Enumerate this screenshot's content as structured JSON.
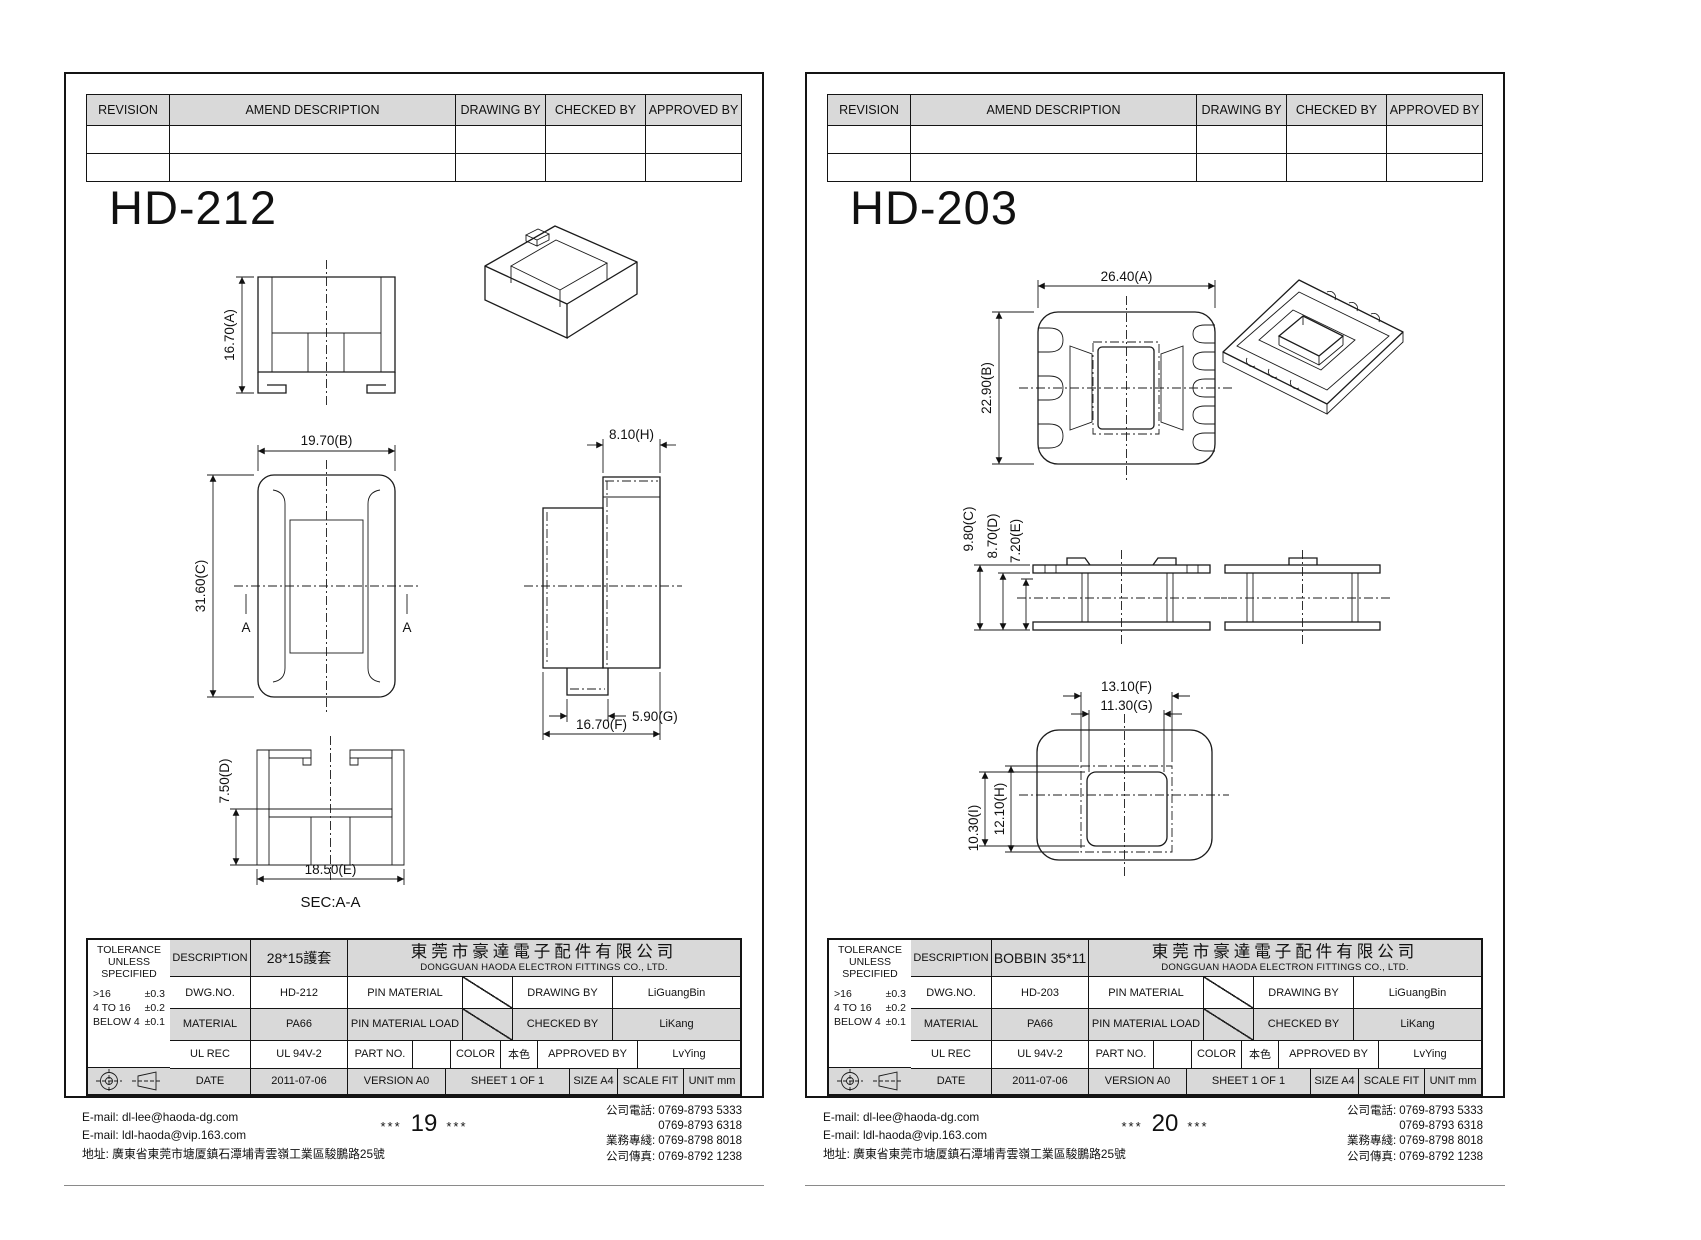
{
  "sheets": [
    {
      "title": "HD-212",
      "revision": {
        "headers": [
          "REVISION",
          "AMEND DESCRIPTION",
          "DRAWING BY",
          "CHECKED BY",
          "APPROVED BY"
        ]
      },
      "dims": {
        "a": "16.70(A)",
        "b": "19.70(B)",
        "c": "31.60(C)",
        "d": "7.50(D)",
        "e": "18.50(E)",
        "f": "16.70(F)",
        "g": "5.90(G)",
        "h": "8.10(H)"
      },
      "section": {
        "marker": "A",
        "label": "SEC:A-A"
      },
      "tb": {
        "tolerance_title": "TOLERANCE UNLESS SPECIFIED",
        "tol": [
          {
            "range": ">16",
            "val": "±0.3"
          },
          {
            "range": "4 TO 16",
            "val": "±0.2"
          },
          {
            "range": "BELOW 4",
            "val": "±0.1"
          }
        ],
        "description_label": "DESCRIPTION",
        "description": "28*15護套",
        "company_cn": "東莞市豪達電子配件有限公司",
        "company_en": "DONGGUAN HAODA ELECTRON FITTINGS CO., LTD.",
        "dwg_label": "DWG.NO.",
        "dwg": "HD-212",
        "pin_material_label": "PIN MATERIAL",
        "drawing_by_label": "DRAWING BY",
        "drawing_by": "LiGuangBin",
        "material_label": "MATERIAL",
        "material": "PA66",
        "pin_load_label": "PIN MATERIAL LOAD",
        "checked_by_label": "CHECKED BY",
        "checked_by": "LiKang",
        "ul_label": "UL REC",
        "ul": "UL 94V-2",
        "part_label": "PART NO.",
        "part": "",
        "color_label": "COLOR",
        "color": "本色",
        "approved_by_label": "APPROVED BY",
        "approved_by": "LvYing",
        "date_label": "DATE",
        "date": "2011-07-06",
        "version": "VERSION A0",
        "sheet": "SHEET 1 OF 1",
        "size": "SIZE A4",
        "scale": "SCALE FIT",
        "unit": "UNIT mm"
      },
      "footer": {
        "email1": "E-mail: dl-lee@haoda-dg.com",
        "email2": "E-mail: ldl-haoda@vip.163.com",
        "address": "地址: 廣東省東莞市塘厦鎮石潭埔青雲嶺工業區駿鵬路25號",
        "stars": "***",
        "page": "19",
        "phones": [
          {
            "label": "公司電話:",
            "value": "0769-8793 5333"
          },
          {
            "label": "",
            "value": "0769-8793 6318"
          },
          {
            "label": "業務專綫:",
            "value": "0769-8798 8018"
          },
          {
            "label": "公司傳真:",
            "value": "0769-8792 1238"
          }
        ]
      }
    },
    {
      "title": "HD-203",
      "revision": {
        "headers": [
          "REVISION",
          "AMEND DESCRIPTION",
          "DRAWING BY",
          "CHECKED BY",
          "APPROVED BY"
        ]
      },
      "dims": {
        "a": "26.40(A)",
        "b": "22.90(B)",
        "c": "9.80(C)",
        "d": "8.70(D)",
        "e": "7.20(E)",
        "f": "13.10(F)",
        "g": "11.30(G)",
        "h": "12.10(H)",
        "i": "10.30(I)"
      },
      "tb": {
        "tolerance_title": "TOLERANCE UNLESS SPECIFIED",
        "tol": [
          {
            "range": ">16",
            "val": "±0.3"
          },
          {
            "range": "4 TO 16",
            "val": "±0.2"
          },
          {
            "range": "BELOW 4",
            "val": "±0.1"
          }
        ],
        "description_label": "DESCRIPTION",
        "description": "BOBBIN 35*11",
        "company_cn": "東莞市豪達電子配件有限公司",
        "company_en": "DONGGUAN HAODA ELECTRON FITTINGS CO., LTD.",
        "dwg_label": "DWG.NO.",
        "dwg": "HD-203",
        "pin_material_label": "PIN MATERIAL",
        "drawing_by_label": "DRAWING BY",
        "drawing_by": "LiGuangBin",
        "material_label": "MATERIAL",
        "material": "PA66",
        "pin_load_label": "PIN MATERIAL LOAD",
        "checked_by_label": "CHECKED BY",
        "checked_by": "LiKang",
        "ul_label": "UL REC",
        "ul": "UL 94V-2",
        "part_label": "PART NO.",
        "part": "",
        "color_label": "COLOR",
        "color": "本色",
        "approved_by_label": "APPROVED BY",
        "approved_by": "LvYing",
        "date_label": "DATE",
        "date": "2011-07-06",
        "version": "VERSION A0",
        "sheet": "SHEET 1 OF 1",
        "size": "SIZE A4",
        "scale": "SCALE FIT",
        "unit": "UNIT mm"
      },
      "footer": {
        "email1": "E-mail: dl-lee@haoda-dg.com",
        "email2": "E-mail: ldl-haoda@vip.163.com",
        "address": "地址: 廣東省東莞市塘厦鎮石潭埔青雲嶺工業區駿鵬路25號",
        "stars": "***",
        "page": "20",
        "phones": [
          {
            "label": "公司電話:",
            "value": "0769-8793 5333"
          },
          {
            "label": "",
            "value": "0769-8793 6318"
          },
          {
            "label": "業務專綫:",
            "value": "0769-8798 8018"
          },
          {
            "label": "公司傳真:",
            "value": "0769-8792 1238"
          }
        ]
      }
    }
  ]
}
